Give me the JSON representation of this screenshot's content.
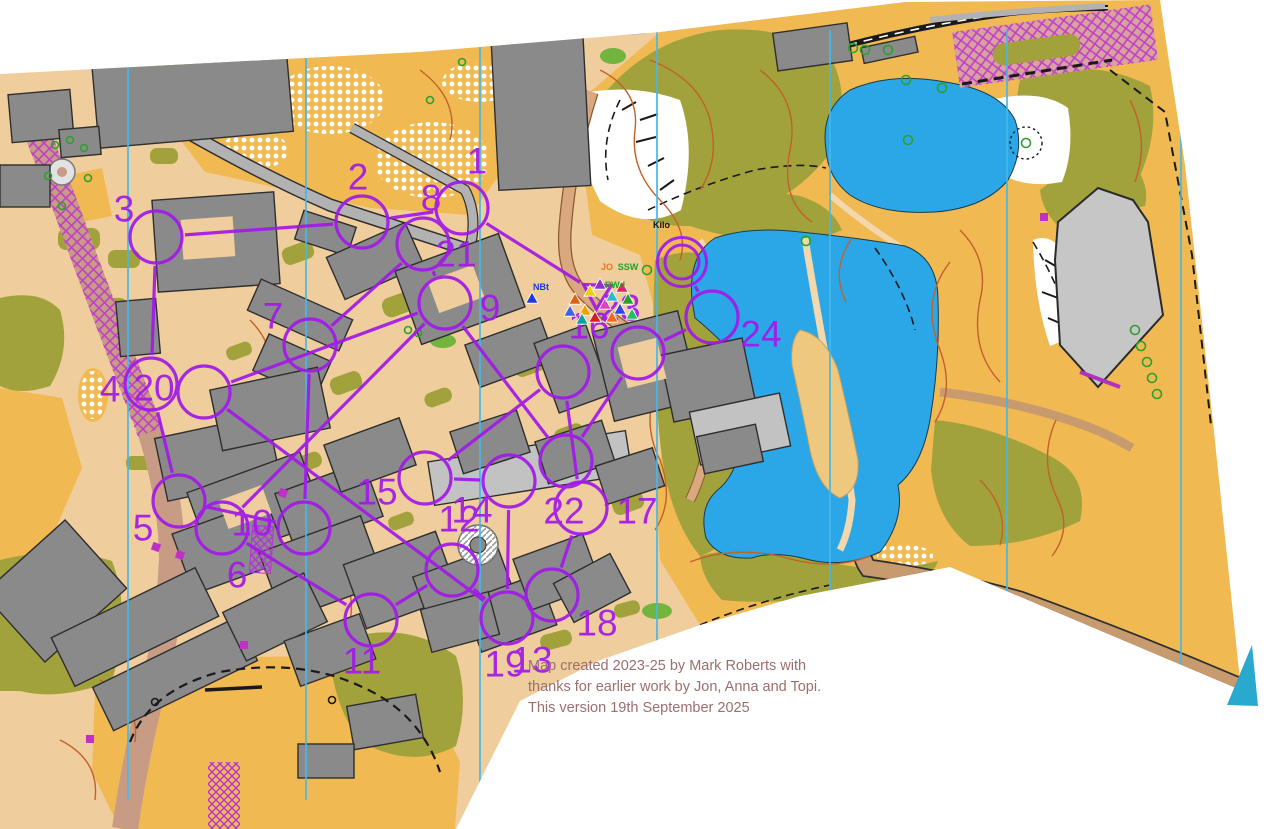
{
  "map": {
    "attribution": {
      "line1": "Map created 2023-25 by Mark Roberts with",
      "line2": "thanks for earlier work by Jon, Anna and Topi.",
      "line3": "This version 19th September 2025"
    },
    "place_label": "Kilo",
    "colors": {
      "course_purple": "#a21ae8",
      "water": "#2ba7e8",
      "open_gold": "#f1b952",
      "rough_olive": "#a2a23c",
      "building_grey": "#8a8a8a",
      "paved_tan": "#f0cd9c",
      "contour_brown": "#c2602c",
      "north_line_cyan": "#45b8e8",
      "attribution_text": "#9c6f6f",
      "oob_pink": "#d9a29e",
      "hatch_magenta": "#c040c8"
    },
    "north_lines_x": [
      128,
      306,
      480,
      657,
      830,
      1007,
      1181
    ],
    "course": {
      "circle_radius": 26,
      "start": {
        "id": "S",
        "x": 597,
        "y": 293
      },
      "finish": {
        "id": "F",
        "x": 682,
        "y": 262,
        "r_inner": 17,
        "r_outer": 24.5
      },
      "controls": [
        {
          "id": "c1",
          "x": 462,
          "y": 208
        },
        {
          "id": "c2",
          "x": 362,
          "y": 222
        },
        {
          "id": "c3",
          "x": 156,
          "y": 237
        },
        {
          "id": "c4",
          "x": 151,
          "y": 384
        },
        {
          "id": "c5",
          "x": 179,
          "y": 501
        },
        {
          "id": "c6",
          "x": 304,
          "y": 528
        },
        {
          "id": "c7",
          "x": 310,
          "y": 345
        },
        {
          "id": "c8",
          "x": 423,
          "y": 244
        },
        {
          "id": "c9",
          "x": 445,
          "y": 303
        },
        {
          "id": "c10",
          "x": 222,
          "y": 528
        },
        {
          "id": "c11",
          "x": 371,
          "y": 620
        },
        {
          "id": "c12",
          "x": 452,
          "y": 570
        },
        {
          "id": "c13",
          "x": 507,
          "y": 618
        },
        {
          "id": "c14",
          "x": 509,
          "y": 481
        },
        {
          "id": "c15",
          "x": 425,
          "y": 478
        },
        {
          "id": "c16",
          "x": 563,
          "y": 372
        },
        {
          "id": "c17",
          "x": 581,
          "y": 508
        },
        {
          "id": "c18",
          "x": 552,
          "y": 595
        },
        {
          "id": "c20",
          "x": 204,
          "y": 392
        },
        {
          "id": "c22",
          "x": 566,
          "y": 461
        },
        {
          "id": "c23",
          "x": 638,
          "y": 353
        },
        {
          "id": "c24",
          "x": 712,
          "y": 317
        }
      ],
      "sequence": [
        "S",
        "c1",
        "c2",
        "c3",
        "c4",
        "c5",
        "c6",
        "c7",
        "c8",
        "c9",
        "c10",
        "c11",
        "c12",
        "c13",
        "c14",
        "c15",
        "c16",
        "c17",
        "c18",
        "c13",
        "c20",
        "c9",
        "c22",
        "c23",
        "c24",
        "F"
      ],
      "labels": [
        {
          "n": "1",
          "x": 477,
          "y": 161
        },
        {
          "n": "2",
          "x": 358,
          "y": 177
        },
        {
          "n": "3",
          "x": 124,
          "y": 209
        },
        {
          "n": "4",
          "x": 110,
          "y": 389
        },
        {
          "n": "5",
          "x": 143,
          "y": 528
        },
        {
          "n": "6",
          "x": 237,
          "y": 575
        },
        {
          "n": "7",
          "x": 273,
          "y": 316
        },
        {
          "n": "8",
          "x": 431,
          "y": 198
        },
        {
          "n": "9",
          "x": 490,
          "y": 308
        },
        {
          "n": "10",
          "x": 252,
          "y": 523
        },
        {
          "n": "11",
          "x": 362,
          "y": 661
        },
        {
          "n": "12",
          "x": 459,
          "y": 519
        },
        {
          "n": "13",
          "x": 532,
          "y": 660
        },
        {
          "n": "14",
          "x": 472,
          "y": 510
        },
        {
          "n": "15",
          "x": 377,
          "y": 492
        },
        {
          "n": "16",
          "x": 589,
          "y": 326
        },
        {
          "n": "17",
          "x": 637,
          "y": 511
        },
        {
          "n": "18",
          "x": 597,
          "y": 623
        },
        {
          "n": "19",
          "x": 505,
          "y": 664
        },
        {
          "n": "20",
          "x": 154,
          "y": 388
        },
        {
          "n": "21",
          "x": 456,
          "y": 254
        },
        {
          "n": "22",
          "x": 564,
          "y": 511
        },
        {
          "n": "23",
          "x": 620,
          "y": 308
        },
        {
          "n": "24",
          "x": 761,
          "y": 334
        }
      ]
    },
    "gps_markers": {
      "triangles": [
        {
          "x": 575,
          "y": 300,
          "c": "#e06010"
        },
        {
          "x": 585,
          "y": 311,
          "c": "#f0a000"
        },
        {
          "x": 595,
          "y": 318,
          "c": "#d02020"
        },
        {
          "x": 605,
          "y": 305,
          "c": "#e040c0"
        },
        {
          "x": 612,
          "y": 297,
          "c": "#30b8d0"
        },
        {
          "x": 620,
          "y": 310,
          "c": "#3048e0"
        },
        {
          "x": 628,
          "y": 300,
          "c": "#28a028"
        },
        {
          "x": 590,
          "y": 292,
          "c": "#f0d000"
        },
        {
          "x": 600,
          "y": 285,
          "c": "#9030d0"
        },
        {
          "x": 582,
          "y": 320,
          "c": "#10a0a0"
        },
        {
          "x": 612,
          "y": 318,
          "c": "#f06820"
        },
        {
          "x": 570,
          "y": 312,
          "c": "#4060f0"
        },
        {
          "x": 622,
          "y": 288,
          "c": "#e02060"
        },
        {
          "x": 632,
          "y": 315,
          "c": "#20c060"
        },
        {
          "x": 532,
          "y": 299,
          "c": "#2038e0"
        }
      ],
      "labels": [
        {
          "text": "JO",
          "x": 607,
          "y": 270,
          "c": "#e07820"
        },
        {
          "text": "SSW",
          "x": 628,
          "y": 270,
          "c": "#28a028"
        },
        {
          "text": "RWd",
          "x": 615,
          "y": 288,
          "c": "#28a028"
        },
        {
          "text": "NBt",
          "x": 541,
          "y": 290,
          "c": "#2038e0"
        }
      ]
    }
  }
}
